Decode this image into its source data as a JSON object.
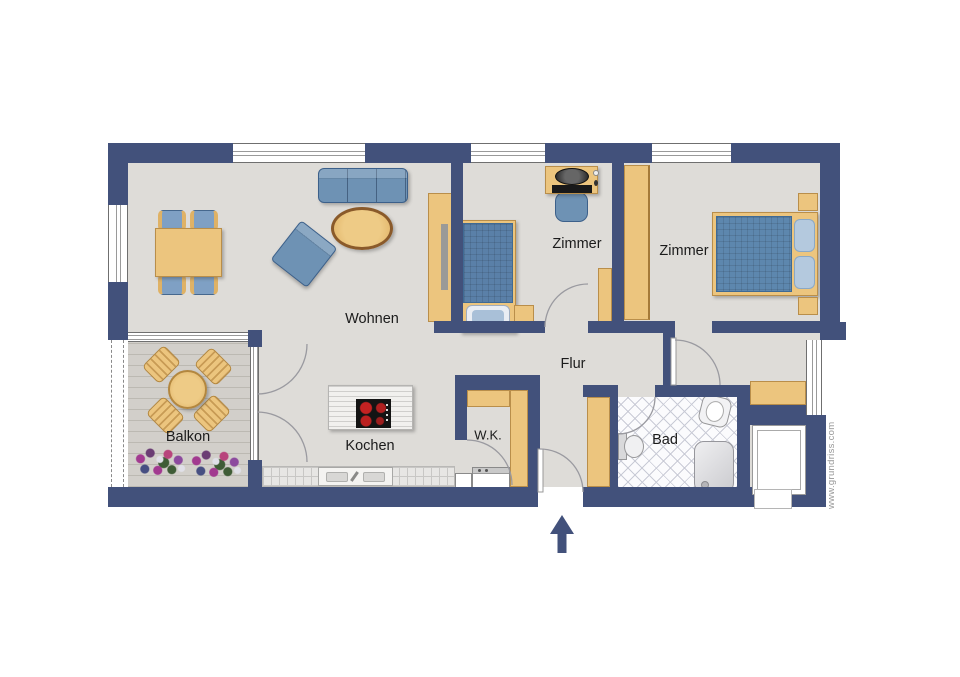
{
  "rooms": {
    "living": "Wohnen",
    "bedroom1": "Zimmer",
    "bedroom2": "Zimmer",
    "hallway": "Flur",
    "kitchen": "Kochen",
    "closet": "W.K.",
    "bathroom": "Bad",
    "balcony": "Balkon"
  },
  "watermark": "www.grundriss.com",
  "colors": {
    "wall": "#42517b",
    "floor": "#dedcd8",
    "deck": "#d2cfca",
    "deck-line": "#bcb9b2",
    "wood": "#ecc57e",
    "wood-dark": "#b98e4a",
    "fblue": "#6e92b4",
    "fblue-dark": "#3c608a",
    "tile-line": "#c9cbd6",
    "burner-red": "#c42222",
    "text": "#1b1b1b",
    "arc": "#9a9aa0",
    "watermark-text": "#979797"
  }
}
